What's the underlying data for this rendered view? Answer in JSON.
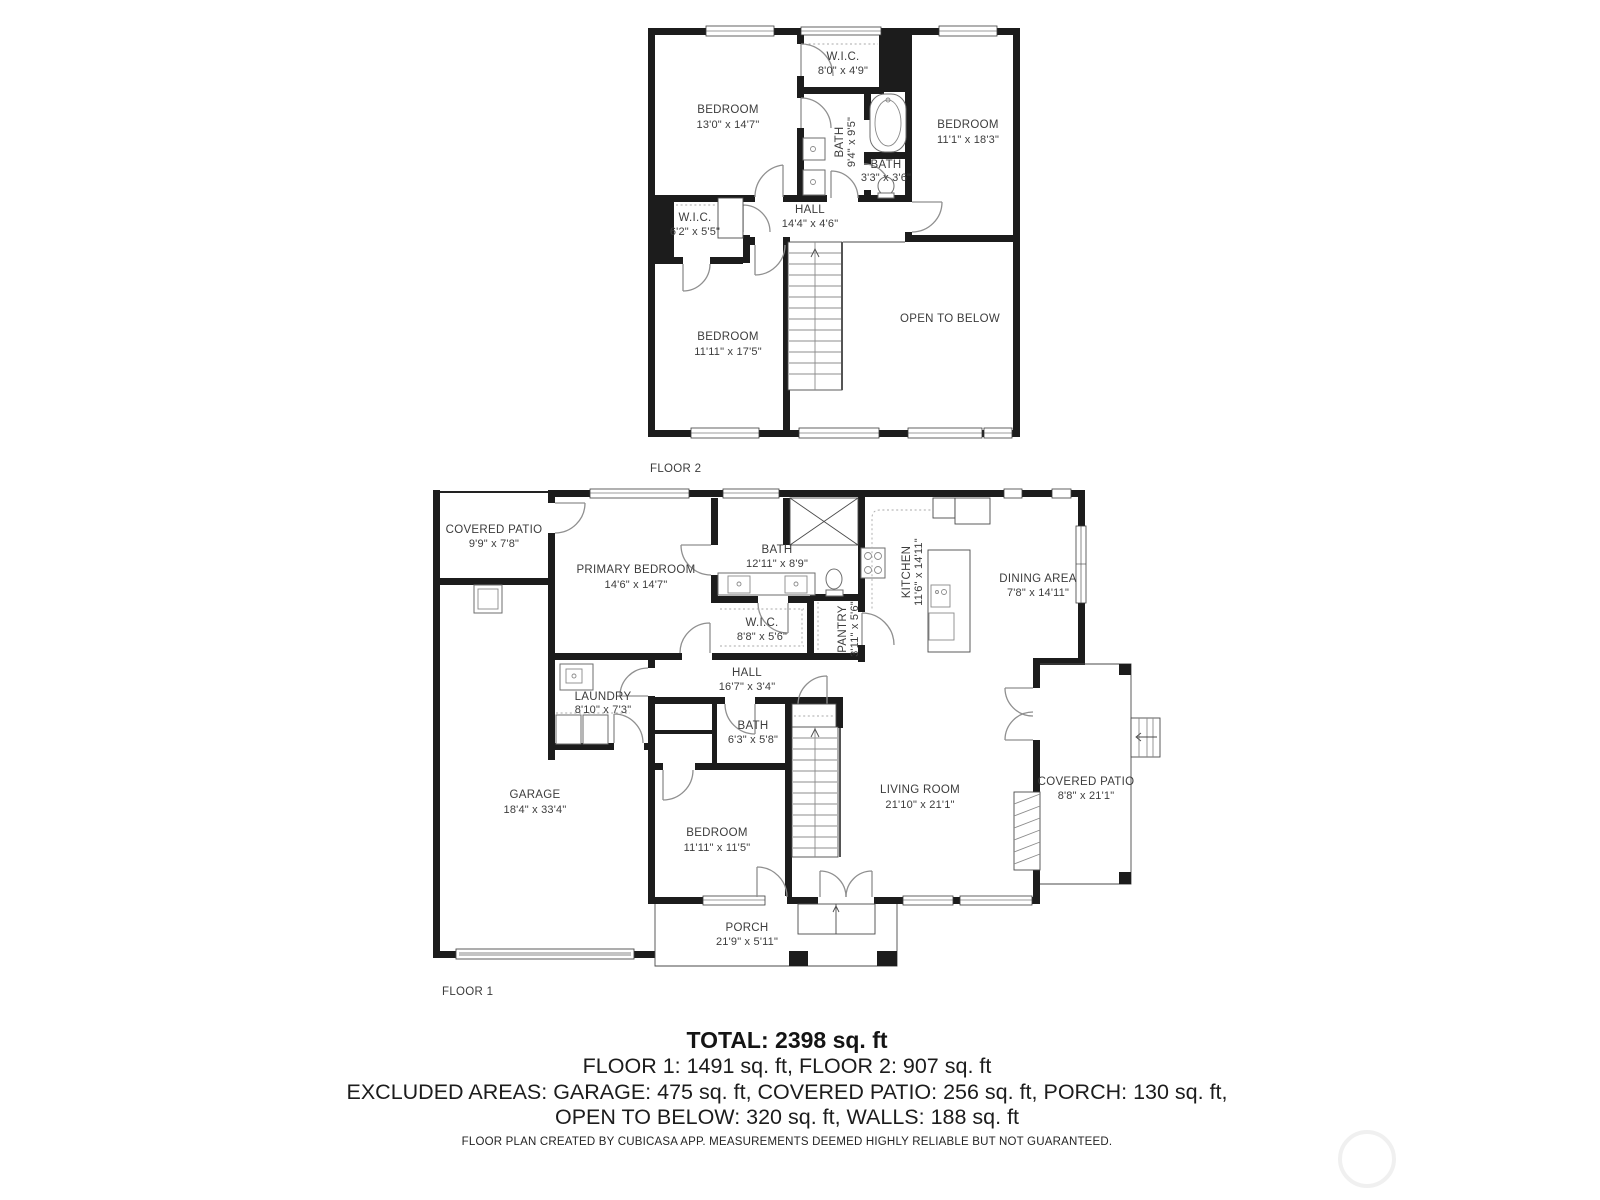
{
  "colors": {
    "wall": "#1c1c1c",
    "door_arc": "#8f8f8f",
    "label_text": "#3c3c3c"
  },
  "floor2": {
    "label": "FLOOR 2",
    "rooms": {
      "bedroom_top_left": {
        "name": "BEDROOM",
        "dims": "13'0\" x 14'7\""
      },
      "wic_top": {
        "name": "W.I.C.",
        "dims": "8'0\" x 4'9\""
      },
      "bath_main": {
        "name": "BATH",
        "dims": "9'4\" x 9'5\""
      },
      "bedroom_right": {
        "name": "BEDROOM",
        "dims": "11'1\" x 18'3\""
      },
      "bath_small": {
        "name": "BATH",
        "dims": "3'3\" x 3'6\""
      },
      "hall": {
        "name": "HALL",
        "dims": "14'4\" x 4'6\""
      },
      "wic_left": {
        "name": "W.I.C.",
        "dims": "6'2\" x 5'5\""
      },
      "bedroom_bottom": {
        "name": "BEDROOM",
        "dims": "11'11\" x 17'5\""
      },
      "open_to_below": {
        "name": "OPEN TO BELOW"
      }
    }
  },
  "floor1": {
    "label": "FLOOR 1",
    "rooms": {
      "covered_patio_back": {
        "name": "COVERED PATIO",
        "dims": "9'9\" x 7'8\""
      },
      "primary_bedroom": {
        "name": "PRIMARY BEDROOM",
        "dims": "14'6\" x 14'7\""
      },
      "bath_primary": {
        "name": "BATH",
        "dims": "12'11\" x 8'9\""
      },
      "wic": {
        "name": "W.I.C.",
        "dims": "8'8\" x 5'6\""
      },
      "pantry": {
        "name": "PANTRY",
        "dims": "3'11\" x 5'6\""
      },
      "kitchen": {
        "name": "KITCHEN",
        "dims": "11'6\" x 14'11\""
      },
      "dining_area": {
        "name": "DINING AREA",
        "dims": "7'8\" x 14'11\""
      },
      "hall": {
        "name": "HALL",
        "dims": "16'7\" x 3'4\""
      },
      "laundry": {
        "name": "LAUNDRY",
        "dims": "8'10\" x 7'3\""
      },
      "bath_hall": {
        "name": "BATH",
        "dims": "6'3\" x 5'8\""
      },
      "garage": {
        "name": "GARAGE",
        "dims": "18'4\" x 33'4\""
      },
      "bedroom": {
        "name": "BEDROOM",
        "dims": "11'11\" x 11'5\""
      },
      "living_room": {
        "name": "LIVING ROOM",
        "dims": "21'10\" x 21'1\""
      },
      "covered_patio_side": {
        "name": "COVERED PATIO",
        "dims": "8'8\" x 21'1\""
      },
      "porch": {
        "name": "PORCH",
        "dims": "21'9\" x 5'11\""
      }
    }
  },
  "summary": {
    "total": "TOTAL: 2398 sq. ft",
    "floors": "FLOOR 1: 1491 sq. ft, FLOOR 2: 907 sq. ft",
    "excluded1": "EXCLUDED AREAS: GARAGE: 475 sq. ft, COVERED PATIO: 256 sq. ft, PORCH: 130 sq. ft,",
    "excluded2": "OPEN TO BELOW: 320 sq. ft, WALLS: 188 sq. ft"
  },
  "footer": {
    "disclaimer": "FLOOR PLAN CREATED BY CUBICASA APP. MEASUREMENTS DEEMED HIGHLY RELIABLE BUT NOT GUARANTEED."
  }
}
